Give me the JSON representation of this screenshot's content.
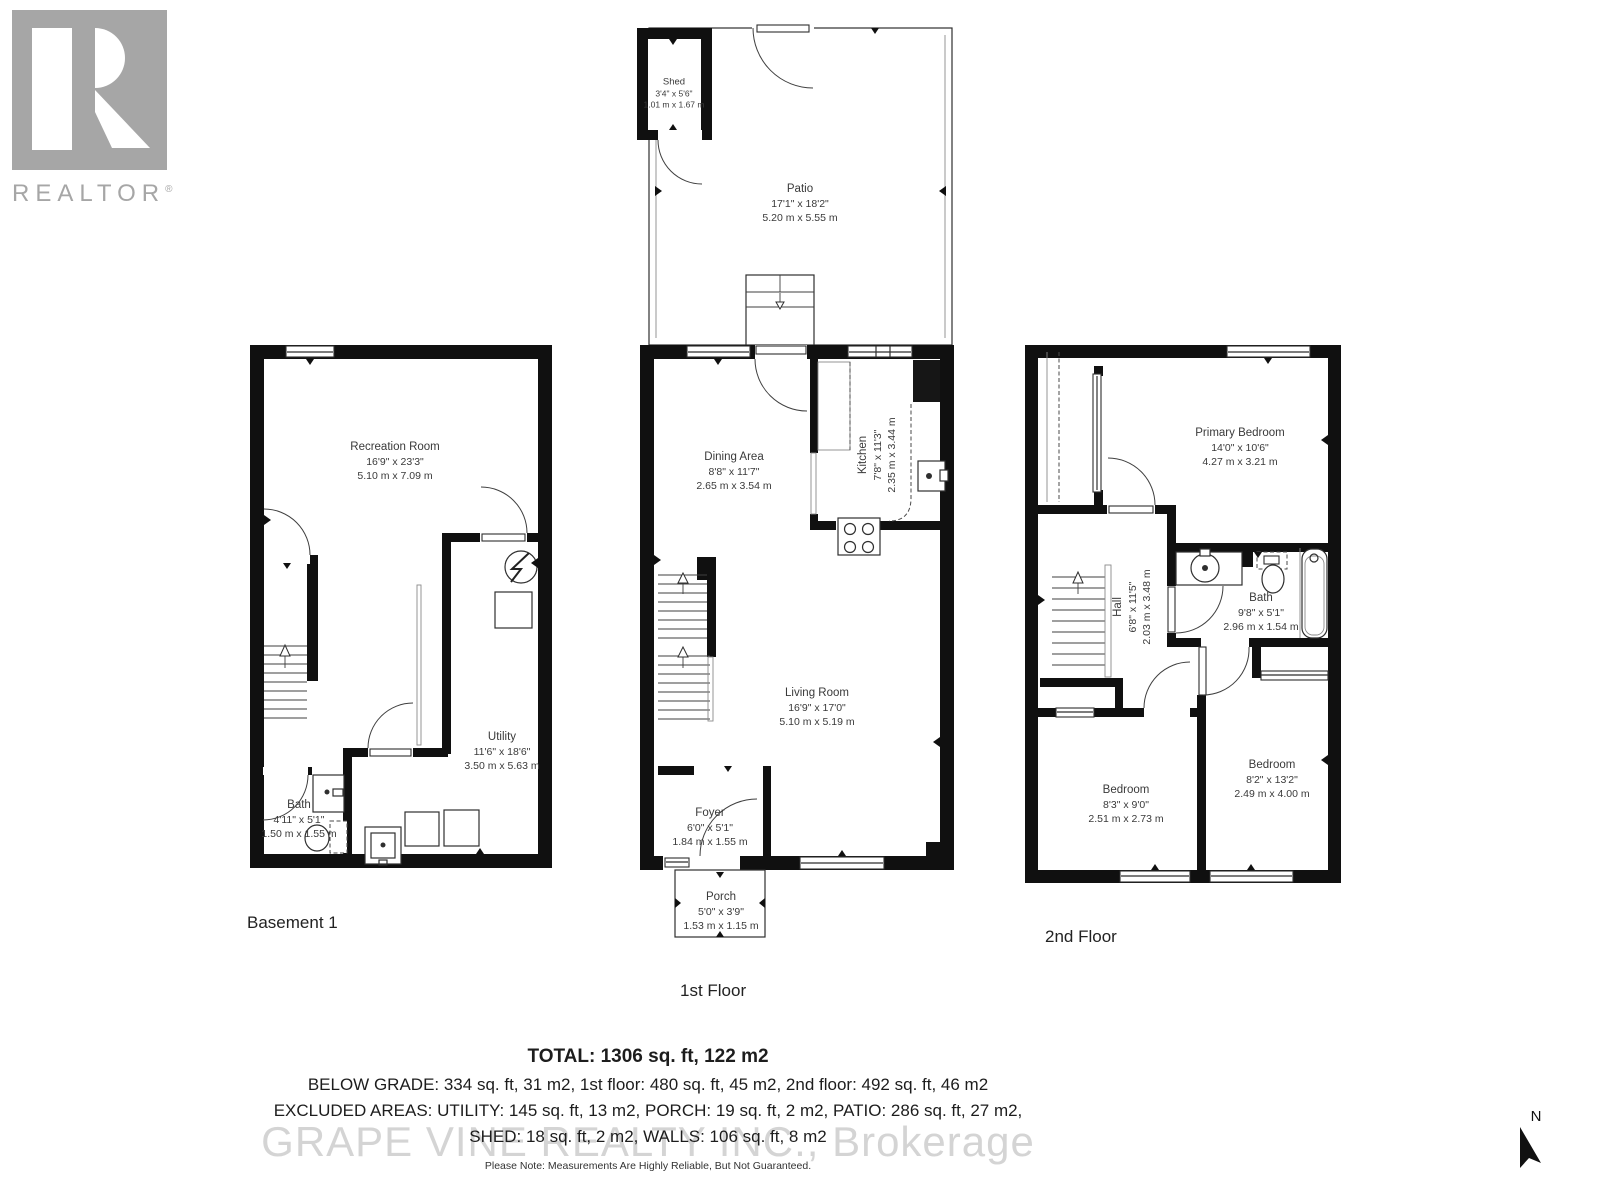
{
  "branding": {
    "logo_letter": "R",
    "logo_text": "REALTOR",
    "registered": "®",
    "watermark": "GRAPE VINE REALTY INC., Brokerage"
  },
  "floors": {
    "basement": "Basement 1",
    "first": "1st Floor",
    "second": "2nd Floor"
  },
  "rooms": {
    "recreation": {
      "name": "Recreation Room",
      "imp": "16'9\" x 23'3\"",
      "met": "5.10 m x 7.09 m"
    },
    "utility": {
      "name": "Utility",
      "imp": "11'6\" x 18'6\"",
      "met": "3.50 m x 5.63 m"
    },
    "bath_basement": {
      "name": "Bath",
      "imp": "4'11\" x 5'1\"",
      "met": "1.50 m x 1.55 m"
    },
    "shed": {
      "name": "Shed",
      "imp": "3'4\" x 5'6\"",
      "met": "1.01 m x 1.67 m"
    },
    "patio": {
      "name": "Patio",
      "imp": "17'1\" x 18'2\"",
      "met": "5.20 m x 5.55 m"
    },
    "dining": {
      "name": "Dining Area",
      "imp": "8'8\" x 11'7\"",
      "met": "2.65 m x 3.54 m"
    },
    "kitchen": {
      "name": "Kitchen",
      "imp": "7'8\" x 11'3\"",
      "met": "2.35 m x 3.44 m"
    },
    "living": {
      "name": "Living Room",
      "imp": "16'9\" x 17'0\"",
      "met": "5.10 m x 5.19 m"
    },
    "foyer": {
      "name": "Foyer",
      "imp": "6'0\" x 5'1\"",
      "met": "1.84 m x 1.55 m"
    },
    "porch": {
      "name": "Porch",
      "imp": "5'0\" x 3'9\"",
      "met": "1.53 m x 1.15 m"
    },
    "primary": {
      "name": "Primary Bedroom",
      "imp": "14'0\" x 10'6\"",
      "met": "4.27 m x 3.21 m"
    },
    "hall": {
      "name": "Hall",
      "imp": "6'8\" x 11'5\"",
      "met": "2.03 m x 3.48 m"
    },
    "bath_second": {
      "name": "Bath",
      "imp": "9'8\" x 5'1\"",
      "met": "2.96 m x 1.54 m"
    },
    "bedroom_small": {
      "name": "Bedroom",
      "imp": "8'3\" x 9'0\"",
      "met": "2.51 m x 2.73 m"
    },
    "bedroom_large": {
      "name": "Bedroom",
      "imp": "8'2\" x 13'2\"",
      "met": "2.49 m x 4.00 m"
    }
  },
  "summary": {
    "total": "TOTAL: 1306 sq. ft, 122 m2",
    "below_grade": "BELOW GRADE: 334 sq. ft, 31 m2, 1st floor: 480 sq. ft, 45 m2, 2nd floor: 492 sq. ft, 46 m2",
    "excluded1": "EXCLUDED AREAS: UTILITY: 145 sq. ft, 13 m2, PORCH: 19 sq. ft, 2 m2, PATIO: 286 sq. ft, 27 m2,",
    "excluded2": "SHED: 18 sq. ft, 2 m2, WALLS: 106 sq. ft, 8 m2",
    "disclaimer": "Please Note: Measurements Are Highly Reliable, But Not Guaranteed."
  },
  "compass": {
    "north": "N"
  },
  "colors": {
    "wall": "#101010",
    "logo_gray": "#a6a6a6",
    "watermark_gray": "#b9b9b9",
    "room_text": "#3a3a3a",
    "summary_text": "#1d1d1d"
  }
}
